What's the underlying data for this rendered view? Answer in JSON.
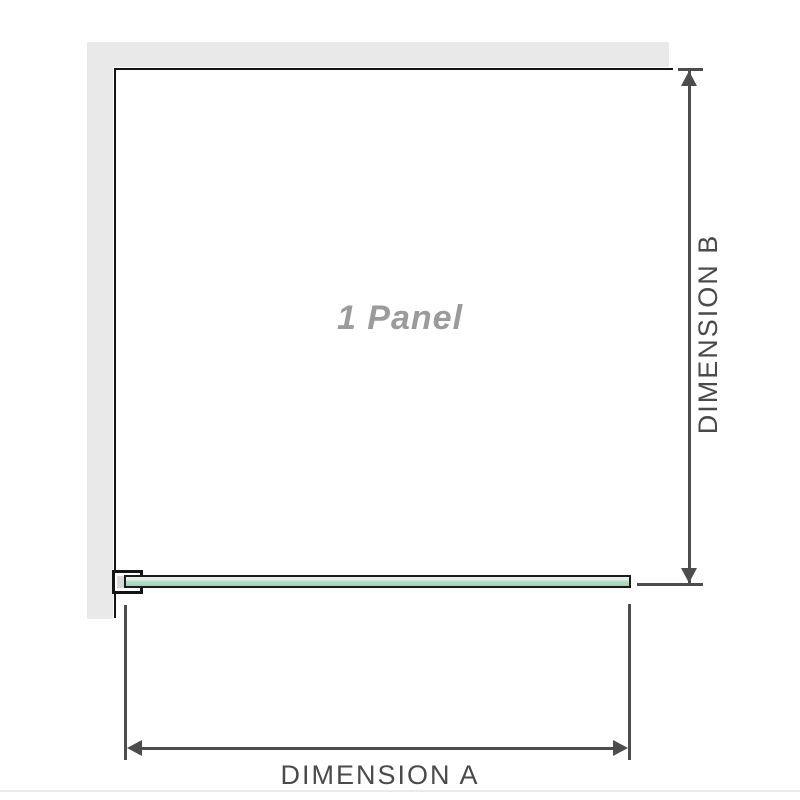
{
  "diagram": {
    "title": "1 Panel",
    "dimension_a": {
      "label": "DIMENSION A"
    },
    "dimension_b": {
      "label": "DIMENSION B"
    },
    "colors": {
      "wall_fill": "#e9e9e9",
      "panel_outline": "#141414",
      "dimension_line": "#4d4d4d",
      "label_text": "#4a4a4a",
      "panel_title_text": "#9b9b9b",
      "glass_green_light": "#e3f2e9",
      "glass_green": "#abdcc0",
      "glass_green_dark": "#98d0ae",
      "baseline": "#ede9e5"
    }
  }
}
